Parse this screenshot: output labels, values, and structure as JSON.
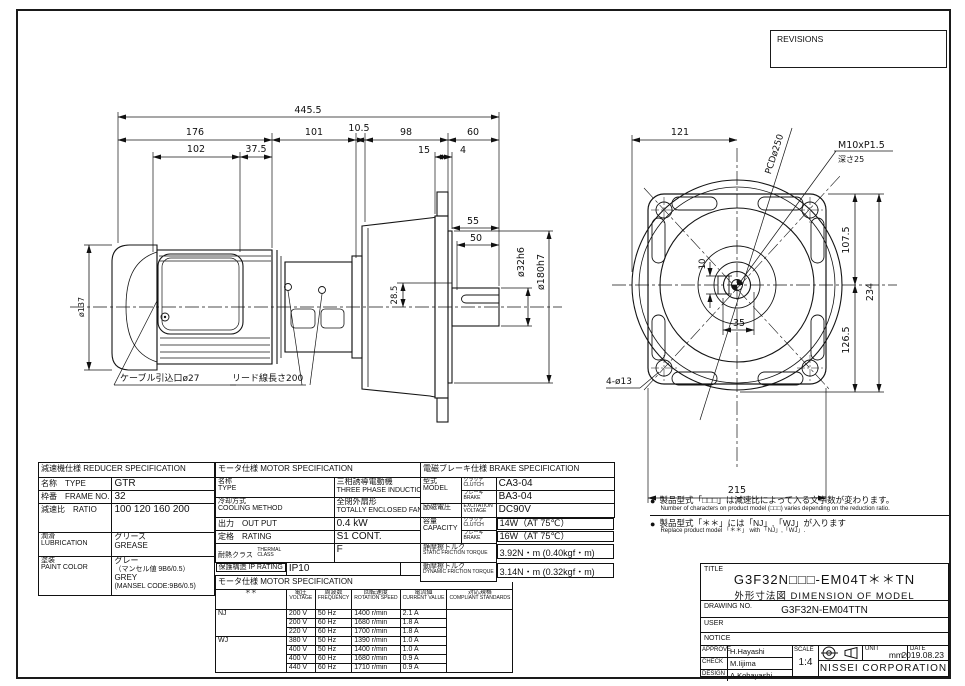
{
  "revisions": {
    "title": "REVISIONS"
  },
  "drawing": {
    "side": {
      "dim_total": "445.5",
      "dim_176": "176",
      "dim_101": "101",
      "dim_105": "10.5",
      "dim_98": "98",
      "dim_60": "60",
      "dim_102": "102",
      "dim_375": "37.5",
      "dim_15": "15",
      "dim_4": "4",
      "dim_55": "55",
      "dim_50": "50",
      "dim_shaft": "ø32h6",
      "dim_spigot": "ø180h7",
      "dim_285": "28.5",
      "dim_137": "ø137",
      "callout_cable": "ケーブル引込口ø27",
      "callout_lead": "リード線長さ200"
    },
    "front": {
      "dim_121": "121",
      "dim_1075": "107.5",
      "dim_234": "234",
      "dim_1265": "126.5",
      "dim_10": "10",
      "dim_35": "35",
      "dim_215": "215",
      "label_pcd": "PCDø250",
      "label_tap": "M10xP1.5",
      "label_tap_depth": "深さ25",
      "label_holes": "4-ø13"
    }
  },
  "notes": {
    "bullet": "●",
    "n1_jp": "製品型式「□□□」は減速比によって入る文字数が変わります。",
    "n1_en": "Number of characters on product model (□□□) varies depending on the reduction ratio.",
    "n2_jp": "製品型式「＊＊」には「NJ」,「WJ」が入ります",
    "n2_en": "Replace product model 「＊＊」 with 「NJ」,「WJ」."
  },
  "reducer": {
    "title": "減速機仕様 REDUCER SPECIFICATION",
    "type_label": "名称　TYPE",
    "type_value": "GTR",
    "frame_label": "枠番　FRAME NO.",
    "frame_value": "32",
    "ratio_label": "減速比　RATIO",
    "ratio_value": "100 120 160 200",
    "lub_label_jp": "潤滑",
    "lub_label_en": "LUBRICATION",
    "lub_value_jp": "グリース",
    "lub_value_en": "GREASE",
    "paint_label_jp": "塗装",
    "paint_label_en": "PAINT COLOR",
    "paint_v1": "グレー",
    "paint_v2": "（マンセル値 9B6/0.5）",
    "paint_v3": "GREY",
    "paint_v4": "(MANSEL CODE:9B6/0.5)"
  },
  "motor": {
    "title": "モータ仕様 MOTOR SPECIFICATION",
    "type_label_jp": "名称",
    "type_label_en": "TYPE",
    "type_jp": "三相誘導電動機",
    "type_en": "THREE PHASE INDUCTION MOTOR",
    "cool_label_jp": "冷却方式",
    "cool_label_en": "COOLING METHOD",
    "cool_jp": "全閉外扇形",
    "cool_en": "TOTALLY ENCLOSED FAN COOLED",
    "out_label": "出力　OUT PUT",
    "out_value": "0.4 kW",
    "rating_label": "定格　RATING",
    "rating_value": "S1 CONT.",
    "thermal_label_jp": "耐熱クラス",
    "thermal_label_en": "THERMAL CLASS",
    "thermal_value": "F",
    "ip_label": "保護構造 IP RATING",
    "ip_value": "IP10",
    "sub_title": "モータ仕様 MOTOR SPECIFICATION",
    "col_mark": "＊＊",
    "col_voltage_jp": "電圧",
    "col_voltage_en": "VOLTAGE",
    "col_freq_jp": "周波数",
    "col_freq_en": "FREQUENCY",
    "col_speed_jp": "回転速度",
    "col_speed_en": "ROTATION SPEED",
    "col_current_jp": "電流値",
    "col_current_en": "CURRENT VALUE",
    "col_std_jp": "対応規格",
    "col_std_en": "COMPLIANT STANDARDS",
    "rows": [
      {
        "g": "NJ",
        "v": "200 V",
        "f": "50 Hz",
        "s": "1400 r/min",
        "c": "2.1 A",
        "std": ""
      },
      {
        "g": "",
        "v": "200 V",
        "f": "60 Hz",
        "s": "1680 r/min",
        "c": "1.8 A",
        "std": ""
      },
      {
        "g": "",
        "v": "220 V",
        "f": "60 Hz",
        "s": "1700 r/min",
        "c": "1.8 A",
        "std": ""
      },
      {
        "g": "WJ",
        "v": "380 V",
        "f": "50 Hz",
        "s": "1390 r/min",
        "c": "1.0 A",
        "std": ""
      },
      {
        "g": "",
        "v": "400 V",
        "f": "50 Hz",
        "s": "1400 r/min",
        "c": "1.0 A",
        "std": ""
      },
      {
        "g": "",
        "v": "400 V",
        "f": "60 Hz",
        "s": "1680 r/min",
        "c": "0.9 A",
        "std": ""
      },
      {
        "g": "",
        "v": "440 V",
        "f": "60 Hz",
        "s": "1710 r/min",
        "c": "0.9 A",
        "std": ""
      }
    ]
  },
  "brake": {
    "title": "電磁ブレーキ仕様 BRAKE SPECIFICATION",
    "model_label_jp": "型式",
    "model_label_en": "MODEL",
    "clutch_jp": "クラッチ",
    "clutch_en": "CLUTCH",
    "brake_jp": "ブレーキ",
    "brake_en": "BRAKE",
    "model_clutch": "CA3-04",
    "model_brake": "BA3-04",
    "volt_label_jp": "励磁電圧",
    "volt_label_en": "EXCITATION VOLTAGE",
    "volt_value": "DC90V",
    "cap_label_jp": "容量",
    "cap_label_en": "CAPACITY",
    "cap_clutch": "14W（AT 75℃）",
    "cap_brake": "16W（AT 75℃）",
    "static_label_jp": "静摩擦トルク",
    "static_label_en": "STATIC FRICTION TORQUE",
    "static_value": "3.92N・m (0.40kgf・m)",
    "dynamic_label_jp": "動摩擦トルク",
    "dynamic_label_en": "DYNAMIC FRICTION TORQUE",
    "dynamic_value": "3.14N・m (0.32kgf・m)"
  },
  "title_block": {
    "title_label": "TITLE",
    "model": "G3F32N□□□-EM04T＊＊TN",
    "subtitle": "外形寸法図 DIMENSION OF MODEL",
    "drawing_no_label": "DRAWING NO.",
    "drawing_no": "G3F32N-EM04TTN",
    "user_label": "USER",
    "notice_label": "NOTICE",
    "approve_label": "APPROVE",
    "approve": "H.Hayashi",
    "check_label": "CHECK",
    "check": "M.Iijima",
    "design_label": "DESIGN",
    "design": "A.Kobayashi",
    "scale_label": "SCALE",
    "scale": "1:4",
    "unit_label": "UNIT",
    "unit": "mm",
    "date_label": "DATE",
    "date": "2019.08.23",
    "company": "NISSEI  CORPORATION"
  }
}
